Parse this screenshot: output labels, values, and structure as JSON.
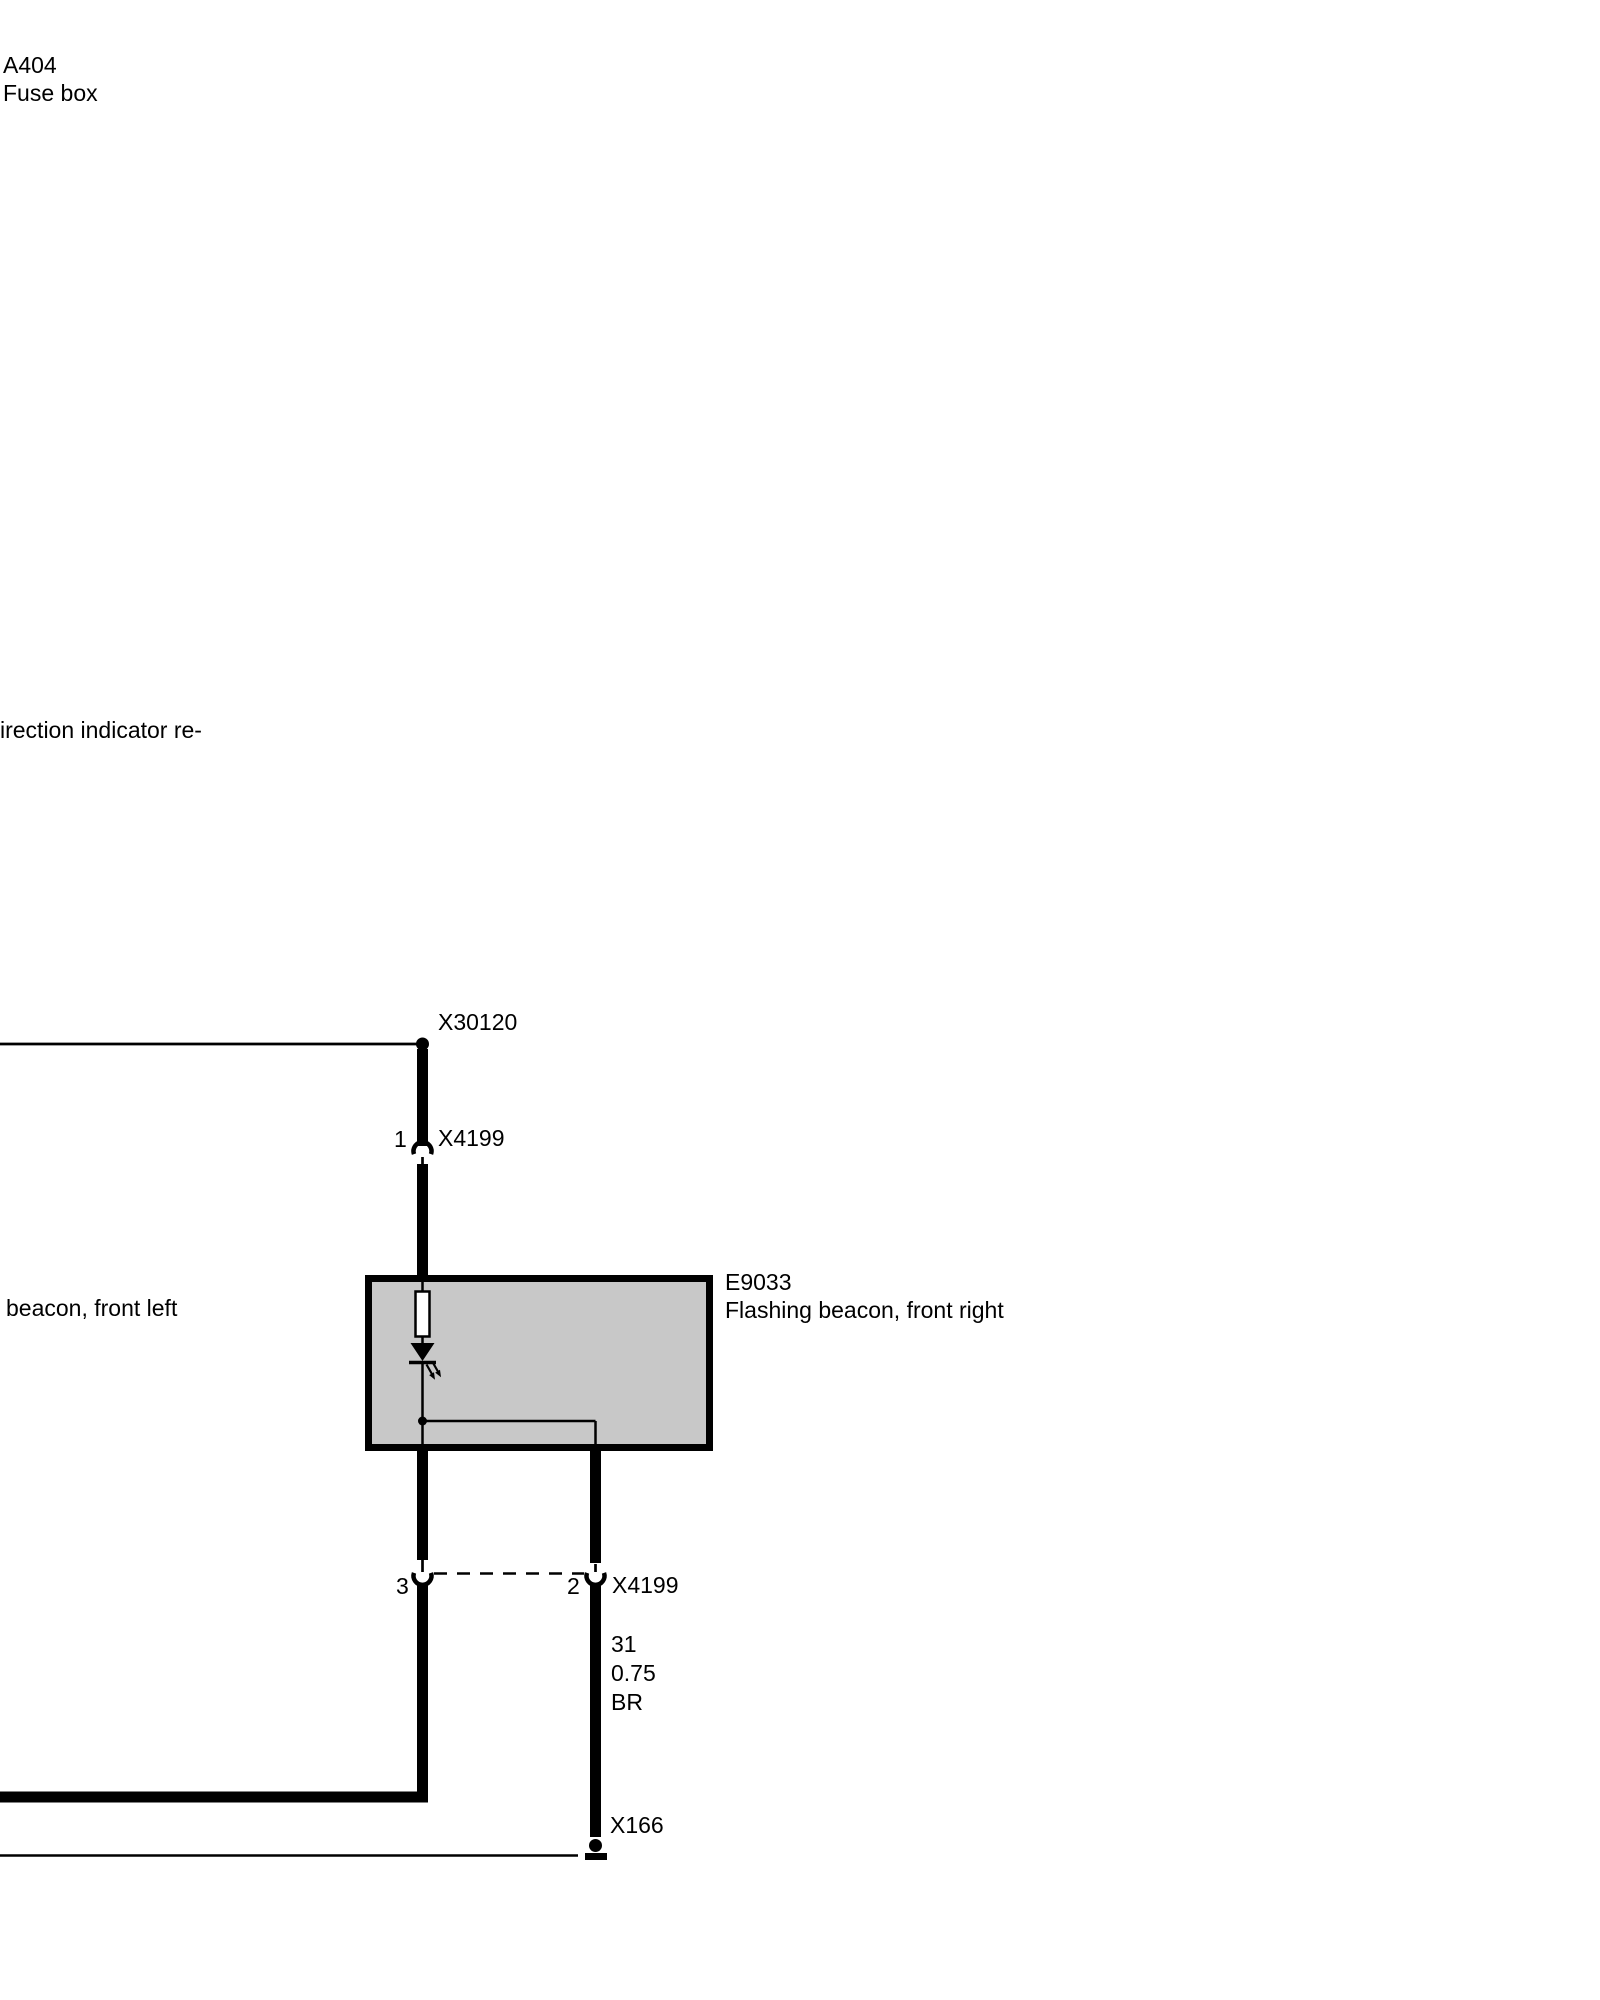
{
  "diagram": {
    "fuse_box": {
      "id": "A404",
      "label": "Fuse box"
    },
    "cutoff_note": "irection indicator re-",
    "beacon_left_label": "beacon, front left",
    "beacon_right": {
      "id": "E9033",
      "label": "Flashing beacon, front right"
    },
    "connector_top": {
      "id": "X30120"
    },
    "plug_upper": {
      "pin": "1",
      "id": "X4199"
    },
    "plug_lower": {
      "pin_left": "3",
      "pin_right": "2",
      "id": "X4199"
    },
    "wire_spec": {
      "circuit": "31",
      "cross_section": "0.75",
      "color_code": "BR"
    },
    "ground": {
      "id": "X166"
    },
    "colors": {
      "box_fill": "#c8c8c8",
      "line": "#000000"
    }
  }
}
